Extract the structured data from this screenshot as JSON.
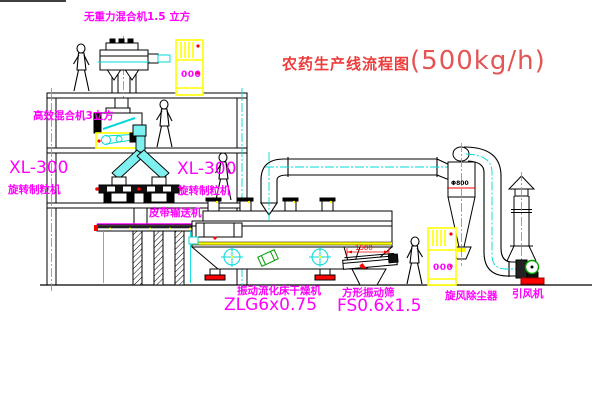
{
  "title": {
    "zh": "农药生产线流程图",
    "capacity": "(500kg/h)"
  },
  "labels": {
    "gravity_mixer": "无重力混合机1.5 立方",
    "high_eff_mixer": "高效混合机3立方",
    "granulator_model_left": "XL-300",
    "granulator_left": "旋转制粒机",
    "granulator_model_right": "XL-300",
    "granulator_right": "旋转制粒机",
    "belt_conveyor": "皮带输送机",
    "dryer": "振动流化床干燥机",
    "dryer_model": "ZLG6x0.75",
    "sieve": "方形振动筛",
    "sieve_model": "FS0.6x1.5",
    "cyclone": "旋风除尘器",
    "fan": "引风机"
  },
  "annotations": {
    "sieve_dim": "1500",
    "cyclone_dim": "Φ800",
    "panel_symbol": "000"
  },
  "colors": {
    "label_magenta": "#ff00ff",
    "title_red": "#ee3b3b",
    "equipment_yellow": "#ffff00",
    "centerline_cyan": "#00d8d8",
    "chute_cyan": "#7ef0f0",
    "alert_red": "#ff0000",
    "motor_green": "#00a000"
  }
}
